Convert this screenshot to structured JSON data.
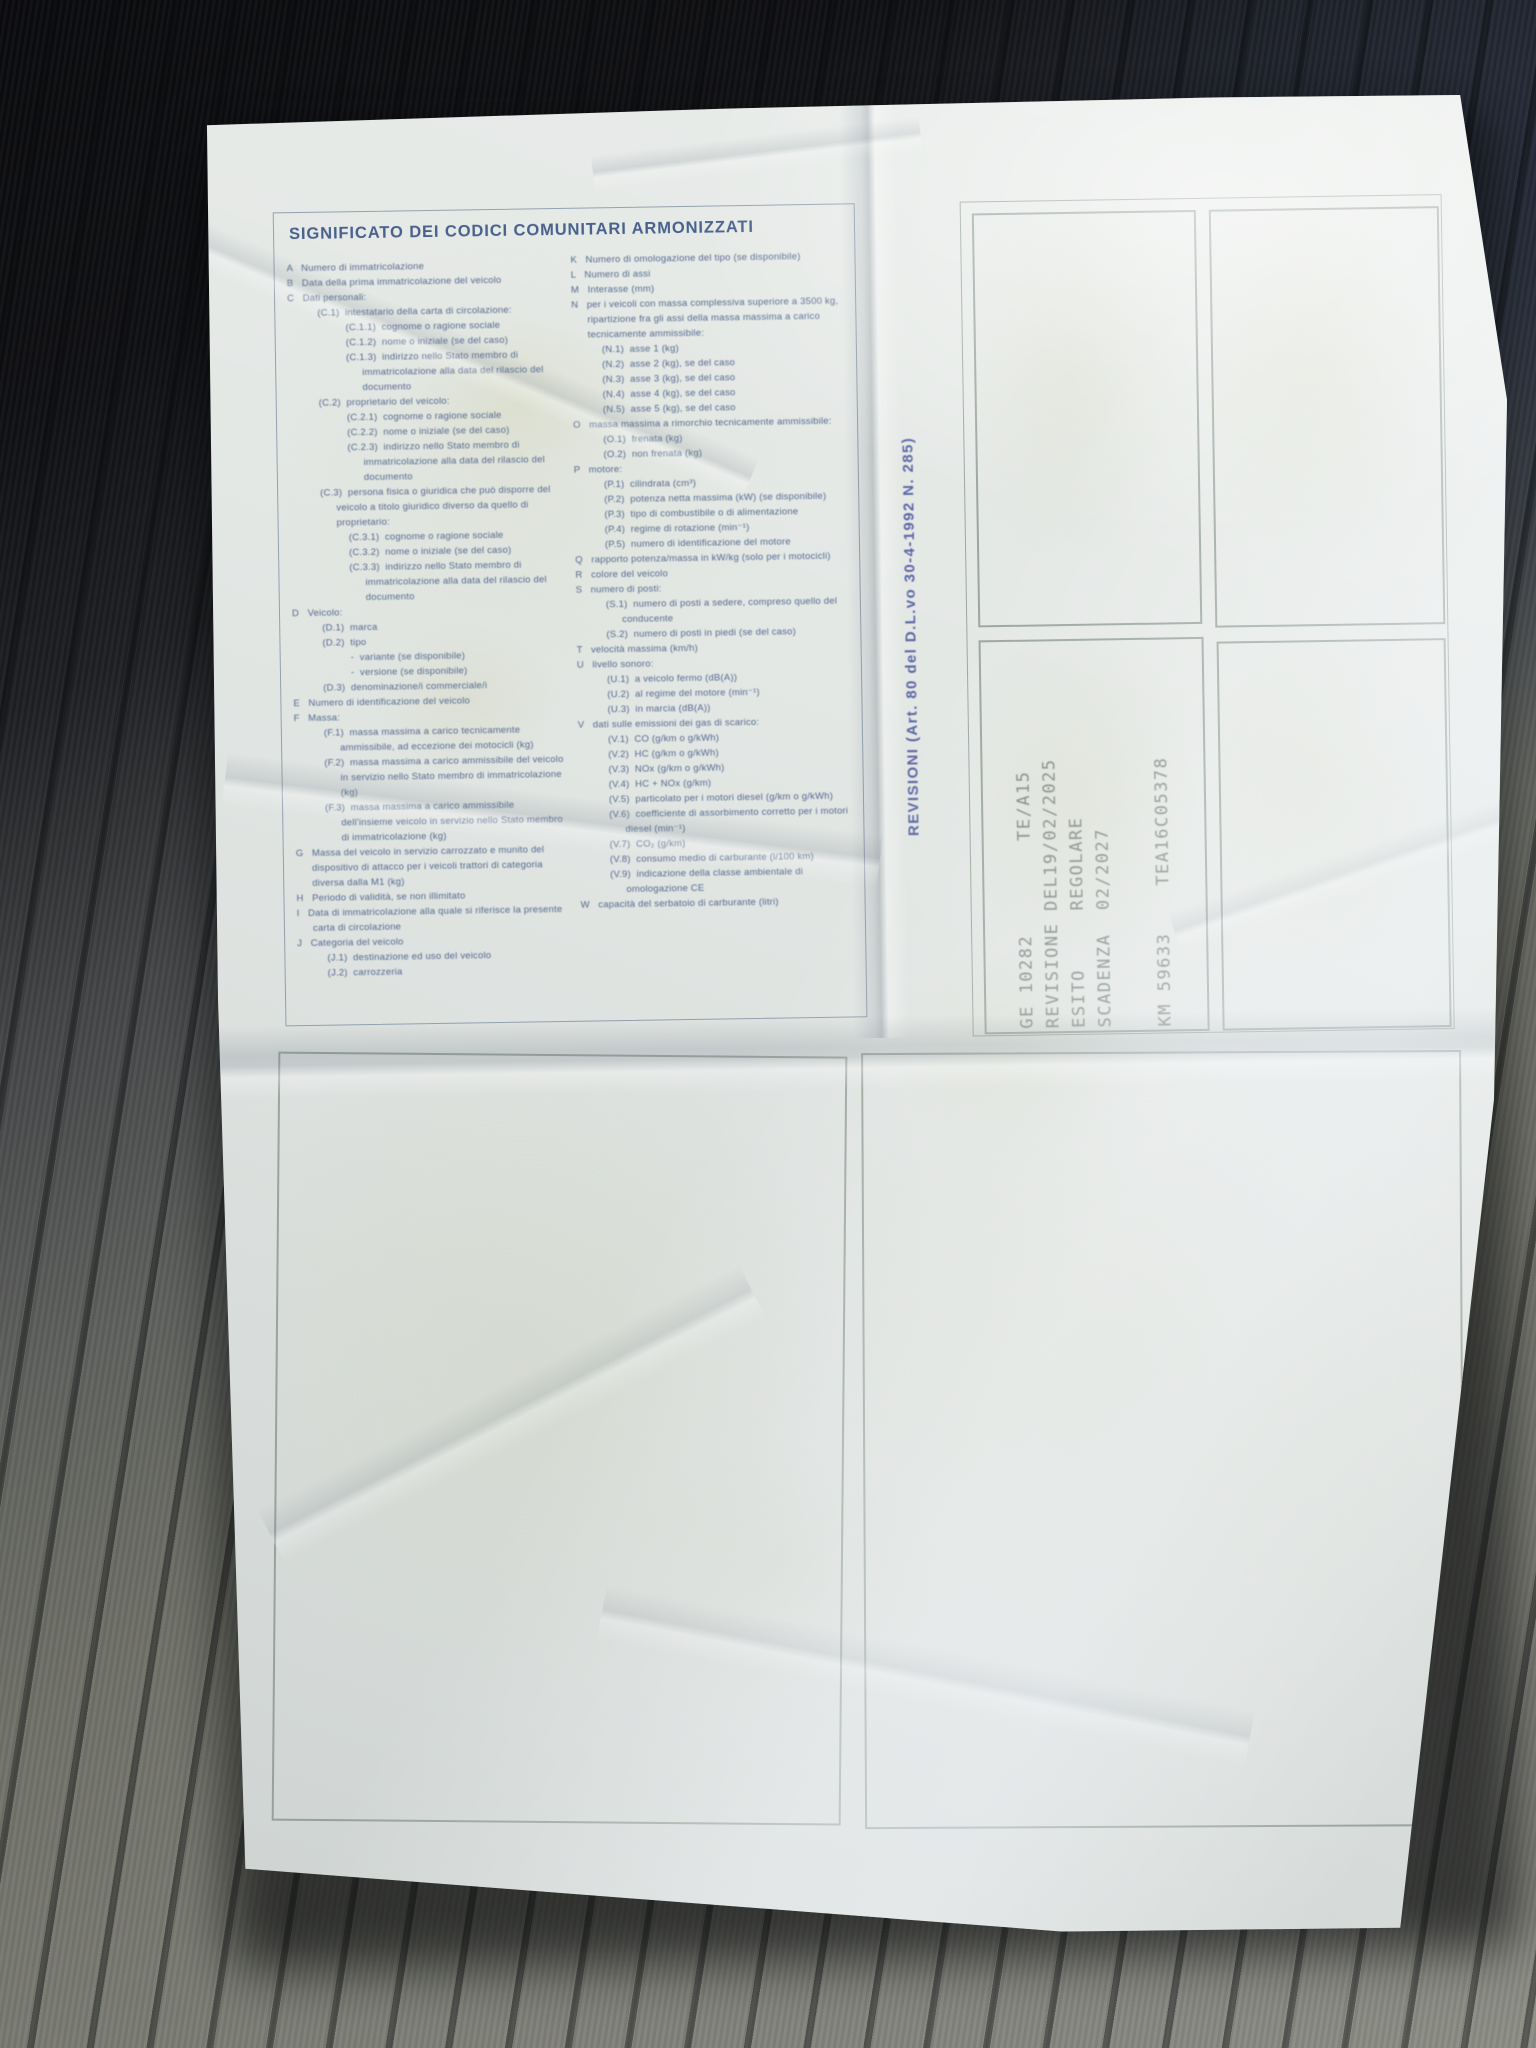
{
  "colors": {
    "ink-blue": "#53688f",
    "header-blue": "#49618c",
    "label-blue": "#5b66a4",
    "stamp-gray": "rgba(96,106,102,0.78)",
    "paper-white": "#e4e8e5",
    "fabric-gray": "#85867e",
    "box-border-green": "#808d82",
    "box-border-blue": "#7a899e"
  },
  "document": {
    "header": "SIGNIFICATO DEI CODICI COMUNITARI ARMONIZZATI",
    "revisioni_label": "REVISIONI (Art. 80 del D.L.vo 30-4-1992 N. 285)",
    "codes_left": [
      {
        "ind": 0,
        "text": "A   Numero di immatricolazione"
      },
      {
        "ind": 0,
        "text": "B   Data della prima immatricolazione del veicolo"
      },
      {
        "ind": 0,
        "text": "C   Dati personali:"
      },
      {
        "ind": 1,
        "text": "(C.1)  intestatario della carta di circolazione:"
      },
      {
        "ind": 2,
        "text": "(C.1.1)  cognome o ragione sociale"
      },
      {
        "ind": 2,
        "text": "(C.1.2)  nome o iniziale (se del caso)"
      },
      {
        "ind": 2,
        "text": "(C.1.3)  indirizzo nello Stato membro di immatricolazione alla data del rilascio del documento"
      },
      {
        "ind": 1,
        "text": "(C.2)  proprietario del veicolo:"
      },
      {
        "ind": 2,
        "text": "(C.2.1)  cognome o ragione sociale"
      },
      {
        "ind": 2,
        "text": "(C.2.2)  nome o iniziale (se del caso)"
      },
      {
        "ind": 2,
        "text": "(C.2.3)  indirizzo nello Stato membro di immatricolazione alla data del rilascio del documento"
      },
      {
        "ind": 1,
        "text": "(C.3)  persona fisica o giuridica che può disporre del veicolo a titolo giuridico diverso da quello di proprietario:"
      },
      {
        "ind": 2,
        "text": "(C.3.1)  cognome o ragione sociale"
      },
      {
        "ind": 2,
        "text": "(C.3.2)  nome o iniziale (se del caso)"
      },
      {
        "ind": 2,
        "text": "(C.3.3)  indirizzo nello Stato membro di immatricolazione alla data del rilascio del documento"
      },
      {
        "ind": 0,
        "text": "D   Veicolo:"
      },
      {
        "ind": 1,
        "text": "(D.1)  marca"
      },
      {
        "ind": 1,
        "text": "(D.2)  tipo"
      },
      {
        "ind": 2,
        "text": "-  variante (se disponibile)"
      },
      {
        "ind": 2,
        "text": "-  versione (se disponibile)"
      },
      {
        "ind": 1,
        "text": "(D.3)  denominazione/i commerciale/i"
      },
      {
        "ind": 0,
        "text": "E   Numero di identificazione del veicolo"
      },
      {
        "ind": 0,
        "text": "F   Massa:"
      },
      {
        "ind": 1,
        "text": "(F.1)  massa massima a carico tecnicamente ammissibile, ad eccezione dei motocicli (kg)"
      },
      {
        "ind": 1,
        "text": "(F.2)  massa massima a carico ammissibile del veicolo in servizio nello Stato membro di immatricolazione (kg)"
      },
      {
        "ind": 1,
        "text": "(F.3)  massa massima a carico ammissibile dell'insieme veicolo in servizio nello Stato membro di immatricolazione (kg)"
      },
      {
        "ind": 0,
        "text": "G   Massa del veicolo in servizio carrozzato e munito del dispositivo di attacco per i veicoli trattori di categoria diversa dalla M1 (kg)"
      },
      {
        "ind": 0,
        "text": "H   Periodo di validità, se non illimitato"
      },
      {
        "ind": 0,
        "text": "I   Data di immatricolazione alla quale si riferisce la presente carta di circolazione"
      },
      {
        "ind": 0,
        "text": "J   Categoria del veicolo"
      },
      {
        "ind": 1,
        "text": "(J.1)  destinazione ed uso del veicolo"
      },
      {
        "ind": 1,
        "text": "(J.2)  carrozzeria"
      }
    ],
    "codes_right": [
      {
        "ind": 0,
        "text": "K   Numero di omologazione del tipo (se disponibile)"
      },
      {
        "ind": 0,
        "text": "L   Numero di assi"
      },
      {
        "ind": 0,
        "text": "M   Interasse (mm)"
      },
      {
        "ind": 0,
        "text": "N   per i veicoli con massa complessiva superiore a 3500 kg, ripartizione fra gli assi della massa massima a carico tecnicamente ammissibile:"
      },
      {
        "ind": 1,
        "text": "(N.1)  asse 1 (kg)"
      },
      {
        "ind": 1,
        "text": "(N.2)  asse 2 (kg), se del caso"
      },
      {
        "ind": 1,
        "text": "(N.3)  asse 3 (kg), se del caso"
      },
      {
        "ind": 1,
        "text": "(N.4)  asse 4 (kg), se del caso"
      },
      {
        "ind": 1,
        "text": "(N.5)  asse 5 (kg), se del caso"
      },
      {
        "ind": 0,
        "text": "O   massa massima a rimorchio tecnicamente ammissibile:"
      },
      {
        "ind": 1,
        "text": "(O.1)  frenata (kg)"
      },
      {
        "ind": 1,
        "text": "(O.2)  non frenata (kg)"
      },
      {
        "ind": 0,
        "text": "P   motore:"
      },
      {
        "ind": 1,
        "text": "(P.1)  cilindrata (cm³)"
      },
      {
        "ind": 1,
        "text": "(P.2)  potenza netta massima (kW) (se disponibile)"
      },
      {
        "ind": 1,
        "text": "(P.3)  tipo di combustibile o di alimentazione"
      },
      {
        "ind": 1,
        "text": "(P.4)  regime di rotazione (min⁻¹)"
      },
      {
        "ind": 1,
        "text": "(P.5)  numero di identificazione del motore"
      },
      {
        "ind": 0,
        "text": "Q   rapporto potenza/massa in kW/kg (solo per i motocicli)"
      },
      {
        "ind": 0,
        "text": "R   colore del veicolo"
      },
      {
        "ind": 0,
        "text": "S   numero di posti:"
      },
      {
        "ind": 1,
        "text": "(S.1)  numero di posti a sedere, compreso quello del conducente"
      },
      {
        "ind": 1,
        "text": "(S.2)  numero di posti in piedi (se del caso)"
      },
      {
        "ind": 0,
        "text": "T   velocità massima (km/h)"
      },
      {
        "ind": 0,
        "text": "U   livello sonoro:"
      },
      {
        "ind": 1,
        "text": "(U.1)  a veicolo fermo (dB(A))"
      },
      {
        "ind": 1,
        "text": "(U.2)  al regime del motore (min⁻¹)"
      },
      {
        "ind": 1,
        "text": "(U.3)  in marcia (dB(A))"
      },
      {
        "ind": 0,
        "text": "V   dati sulle emissioni dei gas di scarico:"
      },
      {
        "ind": 1,
        "text": "(V.1)  CO (g/km o g/kWh)"
      },
      {
        "ind": 1,
        "text": "(V.2)  HC (g/km o g/kWh)"
      },
      {
        "ind": 1,
        "text": "(V.3)  NOx (g/km o g/kWh)"
      },
      {
        "ind": 1,
        "text": "(V.4)  HC + NOx (g/km)"
      },
      {
        "ind": 1,
        "text": "(V.5)  particolato per i motori diesel (g/km o g/kWh)"
      },
      {
        "ind": 1,
        "text": "(V.6)  coefficiente di assorbimento corretto per i motori diesel (min⁻¹)"
      },
      {
        "ind": 1,
        "text": "(V.7)  CO₂ (g/km)"
      },
      {
        "ind": 1,
        "text": "(V.8)  consumo medio di carburante (l/100 km)"
      },
      {
        "ind": 1,
        "text": "(V.9)  indicazione della classe ambientale di omologazione CE"
      },
      {
        "ind": 0,
        "text": "W   capacità del serbatoio di carburante (litri)"
      }
    ],
    "stamp_lines": [
      "GE 10282        TE/A15",
      "REVISIONE DEL19/02/2025",
      "ESITO     REGOLARE",
      "SCADENZA  02/2027",
      "KM 59633    TEA16C05378"
    ],
    "stamp_fields": {
      "center_code": "GE 10282",
      "office_code": "TE/A15",
      "revision_date": "19/02/2025",
      "esito": "REGOLARE",
      "scadenza": "02/2027",
      "km": "59633",
      "serial": "TEA16C05378"
    }
  }
}
